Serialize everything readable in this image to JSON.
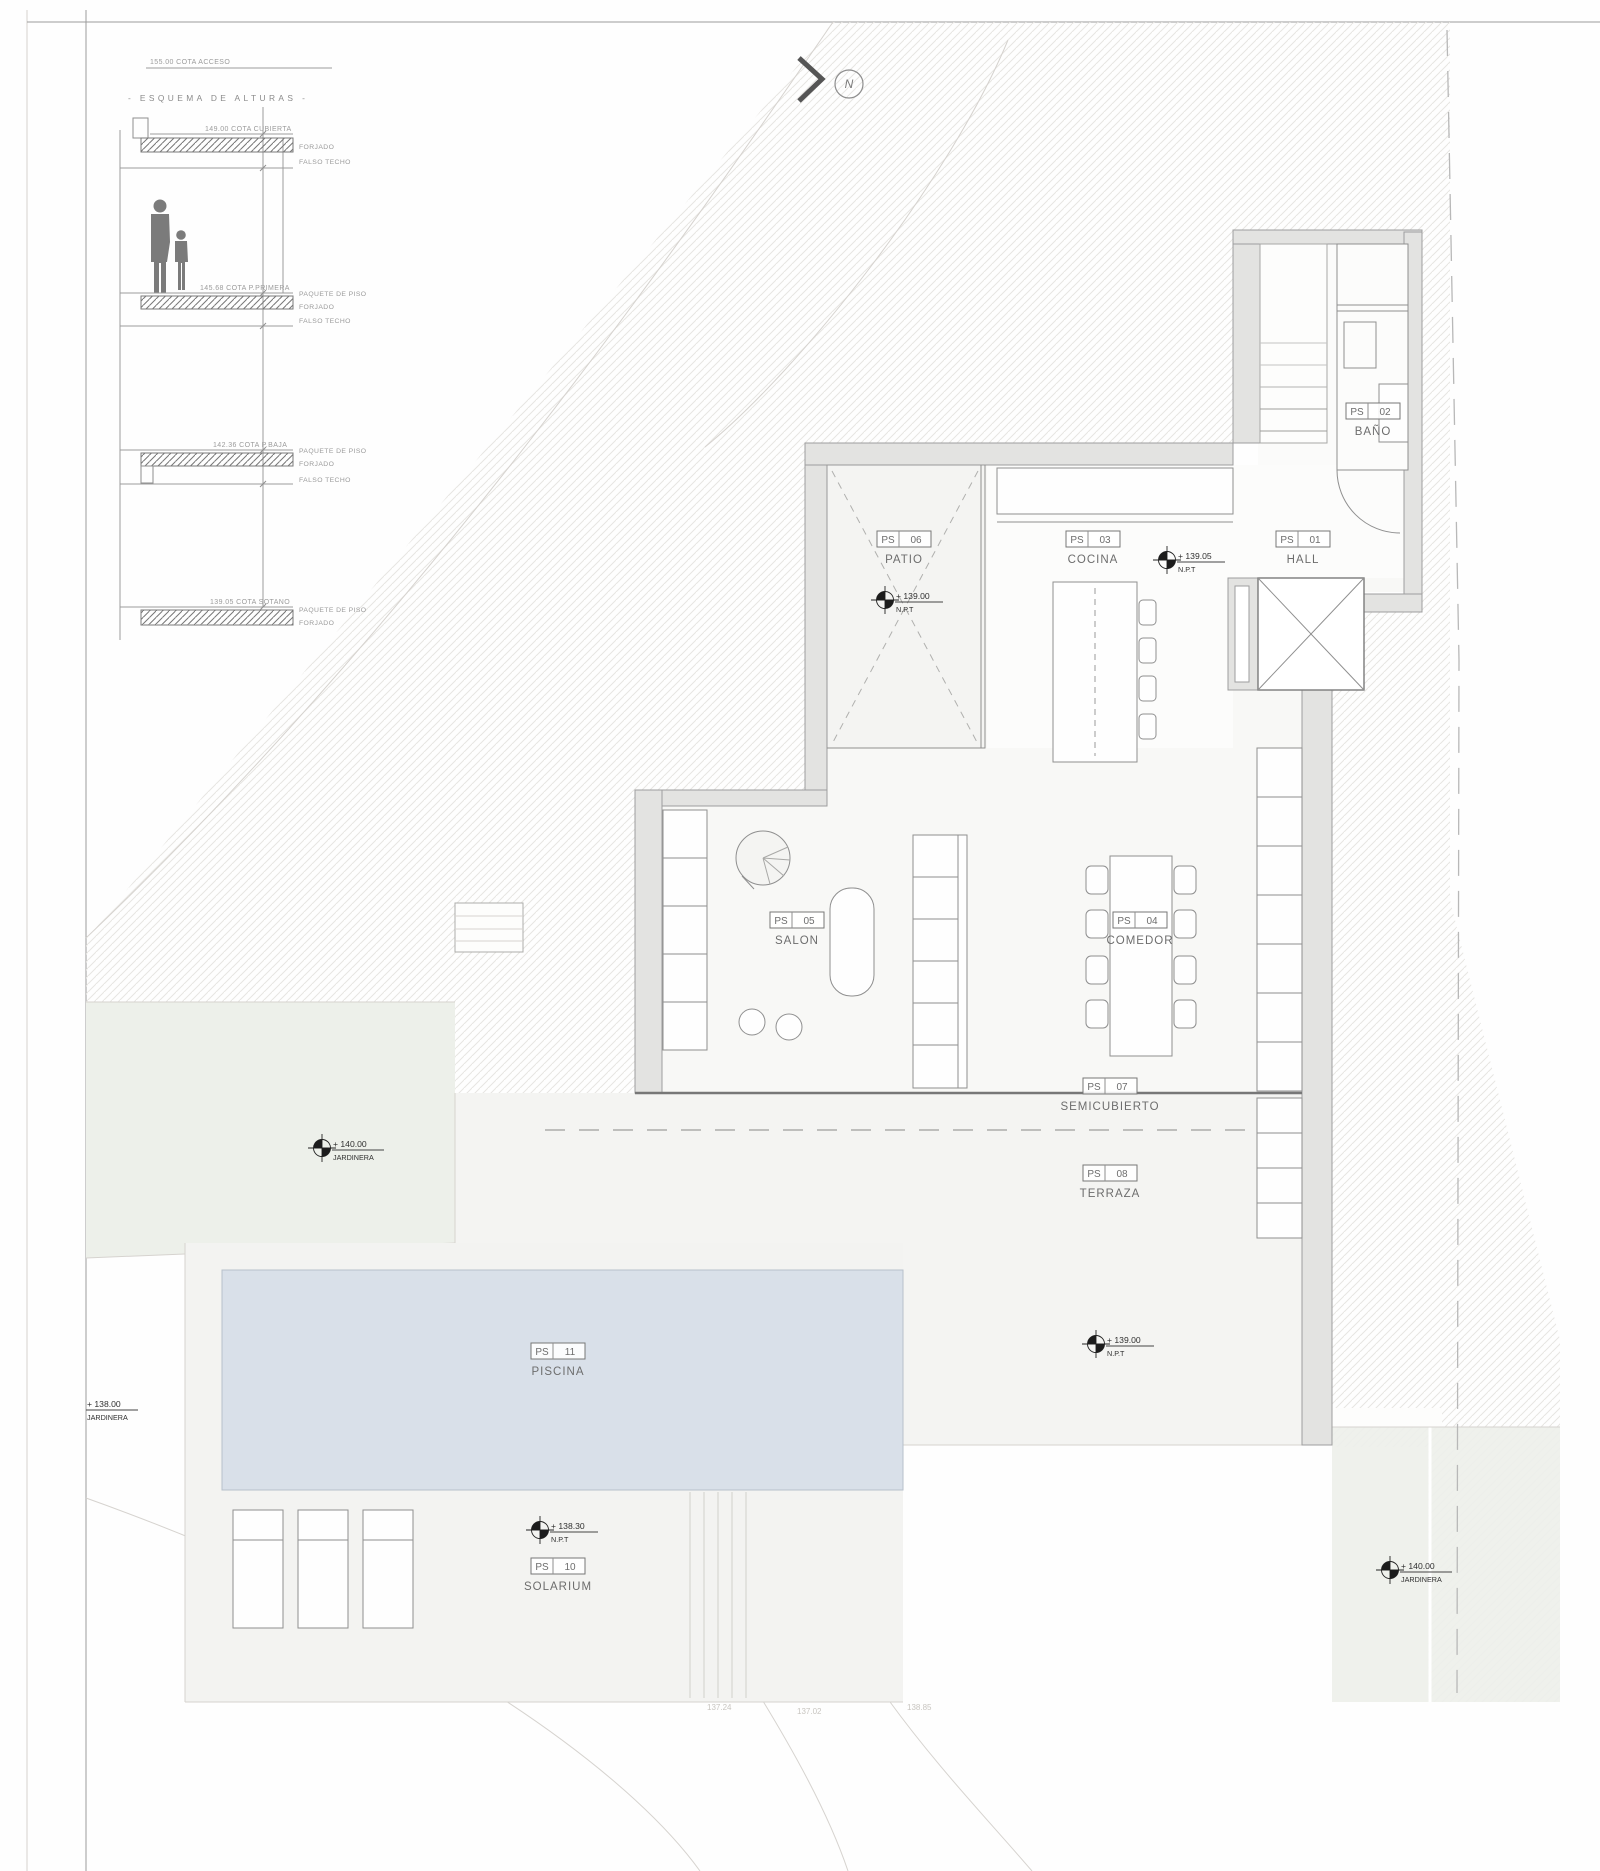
{
  "north": {
    "label": "N"
  },
  "esquema": {
    "access": "155.00 COTA ACCESO",
    "title": "- ESQUEMA DE ALTURAS -",
    "levels": [
      {
        "cota": "149.00 COTA CUBIERTA",
        "labels": [
          "FORJADO",
          "FALSO TECHO"
        ]
      },
      {
        "cota": "145.68 COTA P.PRIMERA",
        "labels": [
          "PAQUETE DE PISO",
          "FORJADO",
          "FALSO TECHO"
        ]
      },
      {
        "cota": "142.36 COTA P.BAJA",
        "labels": [
          "PAQUETE DE PISO",
          "FORJADO",
          "FALSO TECHO"
        ]
      },
      {
        "cota": "139.05 COTA SOTANO",
        "labels": [
          "PAQUETE DE PISO",
          "FORJADO"
        ]
      }
    ]
  },
  "rooms": [
    {
      "prefix": "PS",
      "num": "06",
      "name": "PATIO"
    },
    {
      "prefix": "PS",
      "num": "03",
      "name": "COCINA"
    },
    {
      "prefix": "PS",
      "num": "01",
      "name": "HALL"
    },
    {
      "prefix": "PS",
      "num": "02",
      "name": "BAÑO"
    },
    {
      "prefix": "PS",
      "num": "05",
      "name": "SALON"
    },
    {
      "prefix": "PS",
      "num": "04",
      "name": "COMEDOR"
    },
    {
      "prefix": "PS",
      "num": "07",
      "name": "SEMICUBIERTO"
    },
    {
      "prefix": "PS",
      "num": "08",
      "name": "TERRAZA"
    },
    {
      "prefix": "PS",
      "num": "11",
      "name": "PISCINA"
    },
    {
      "prefix": "PS",
      "num": "10",
      "name": "SOLARIUM"
    }
  ],
  "markers": [
    {
      "value": "+ 139.00",
      "sub": "N.P.T"
    },
    {
      "value": "+ 139.05",
      "sub": "N.P.T"
    },
    {
      "value": "+ 140.00",
      "sub": "JARDINERA"
    },
    {
      "value": "+ 138.00",
      "sub": "JARDINERA"
    },
    {
      "value": "+ 139.00",
      "sub": "N.P.T"
    },
    {
      "value": "+ 138.30",
      "sub": "N.P.T"
    },
    {
      "value": "+ 140.00",
      "sub": "JARDINERA"
    }
  ],
  "contour_labels": [
    "137.24",
    "137.02",
    "138.85"
  ],
  "colors": {
    "pool": "#d9e0e9",
    "planter_green": "#edf0ea",
    "wall_fill": "#e3e3e1",
    "hatch_line": "#e7e5e2",
    "terrace": "#f4f4f2"
  }
}
